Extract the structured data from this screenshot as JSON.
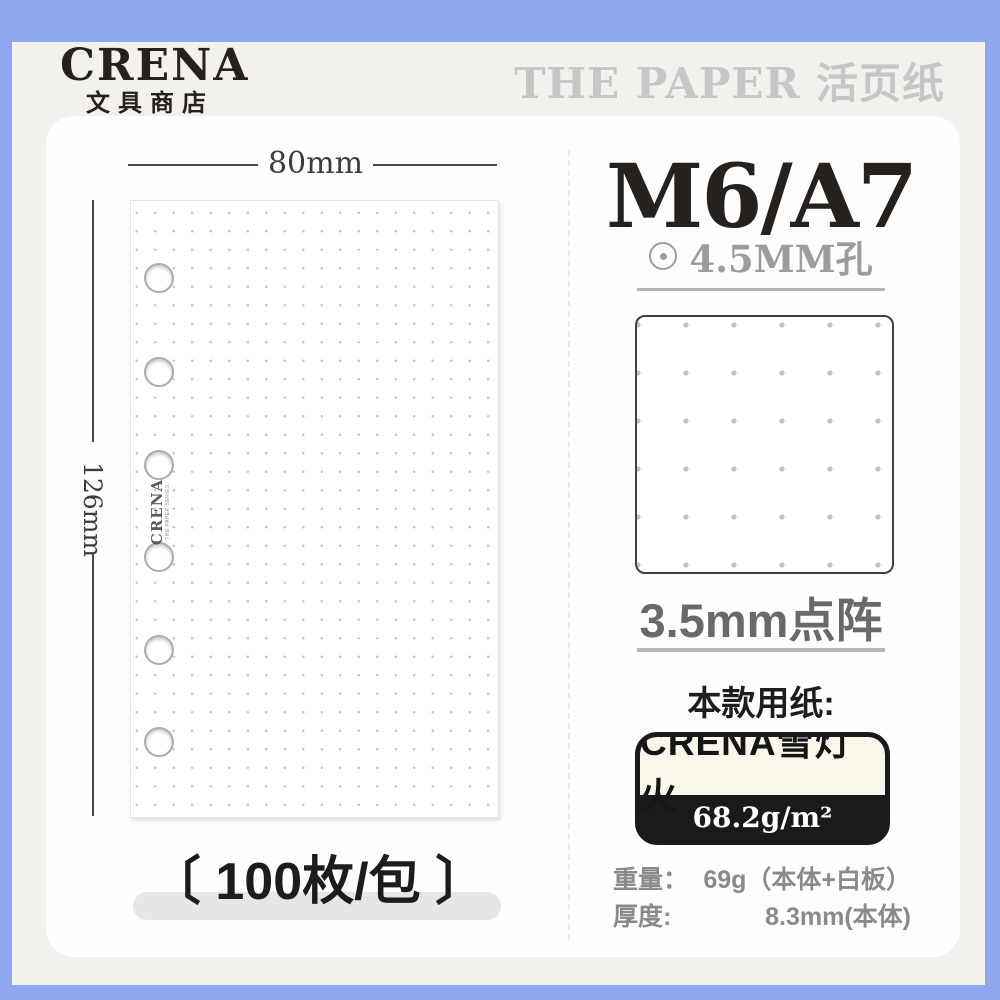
{
  "brand": {
    "logo_title": "CRENA",
    "logo_subtitle": "文具商店"
  },
  "header": {
    "series_title": "THE PAPER 活页纸"
  },
  "page_preview": {
    "width_label": "80mm",
    "height_label": "126mm",
    "watermark_title": "CRENA",
    "watermark_subtitle": "THE PAPER SERIES",
    "hole_count": 6,
    "count_label": "〔 100枚/包 〕"
  },
  "spec": {
    "size_title": "M6/A7",
    "hole_label": "4.5MM孔",
    "grid_label": "3.5mm点阵",
    "paper_heading": "本款用纸:",
    "paper_name": "CRENA雪灯火",
    "paper_weight": "68.2g/m²",
    "rows": [
      {
        "label": "重量：",
        "value": "69g（本体+白板）"
      },
      {
        "label": "厚度:",
        "value": "8.3mm(本体)"
      }
    ]
  },
  "colors": {
    "frame-blue": "#8fa7f0",
    "bg-paper": "#f2f1ee",
    "card-white": "#fdfdfd",
    "page-white": "#ffffff",
    "dot-gray": "#c6c6c6",
    "ink-black": "#26211d",
    "gray-text": "#9c9c9c",
    "mid-gray": "#696969",
    "row-gray": "#8a8a8a",
    "badge-cream": "#faf6ea",
    "badge-black": "#1a1a1a",
    "pill-gray": "#e6e6e6",
    "divider-gray": "#b5b5b5",
    "header-gray": "#c6c6c6"
  }
}
